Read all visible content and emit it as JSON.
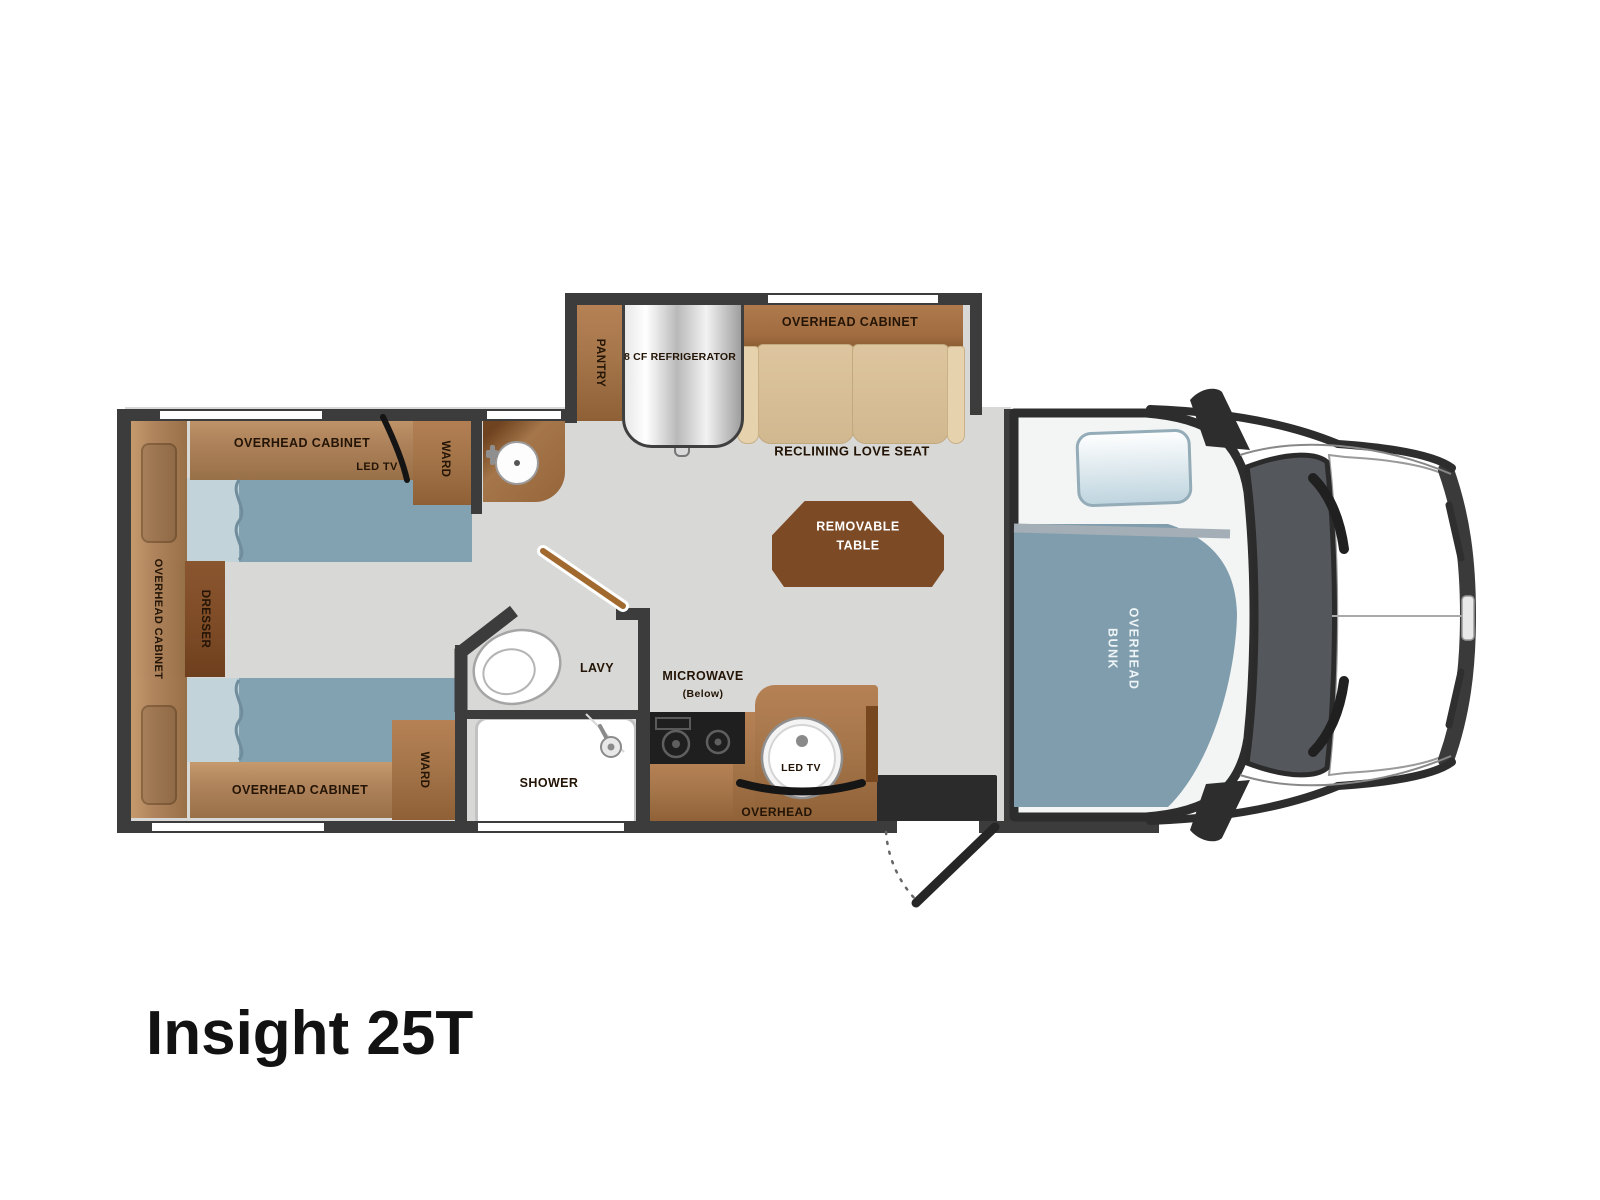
{
  "title": "Insight 25T",
  "colors": {
    "wall": "#3c3c3c",
    "floor": "#d8d8d7",
    "wood_light": "#b0845c",
    "wood_medium": "#a5764a",
    "wood_dark": "#7c4a25",
    "upholstery_tan": "#d9c09a",
    "bed_blue": "#82a2b2",
    "bunk_blue": "#7f9dac",
    "label_text": "#231405"
  },
  "labels": {
    "overhead_cabinet_bed_top": "OVERHEAD CABINET",
    "led_tv_bedroom": "LED TV",
    "ward_top": "WARD",
    "overhead_cabinet_left": "OVERHEAD CABINET",
    "dresser": "DRESSER",
    "overhead_cabinet_bed_bottom": "OVERHEAD CABINET",
    "ward_bottom": "WARD",
    "pantry": "PANTRY",
    "refrigerator": "8 CF REFRIGERATOR",
    "overhead_cabinet_loveseat": "OVERHEAD CABINET",
    "reclining_love_seat": "RECLINING LOVE SEAT",
    "removable_table_line1": "REMOVABLE",
    "removable_table_line2": "TABLE",
    "lavy": "LAVY",
    "microwave": "MICROWAVE",
    "microwave_below": "(Below)",
    "led_tv_kitchen": "LED TV",
    "overhead_kitchen": "OVERHEAD",
    "shower": "SHOWER",
    "overhead_bunk_line1": "OVERHEAD",
    "overhead_bunk_line2": "BUNK"
  }
}
